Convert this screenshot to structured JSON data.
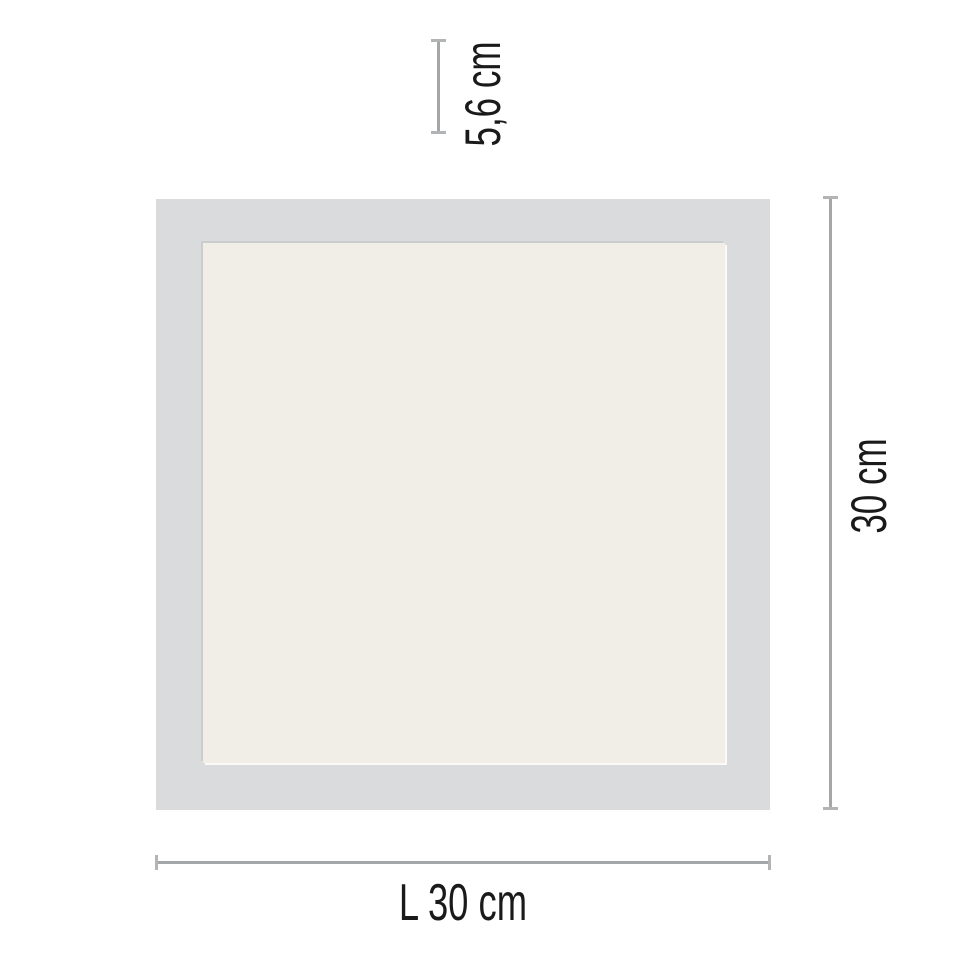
{
  "diagram": {
    "colors": {
      "background": "#ffffff",
      "frame": "#dadbdd",
      "face": "#f1ede7",
      "dim_line": "#a5a6a8",
      "dim_tick": "#b3b4b6",
      "text": "#1a1a1a"
    },
    "dimensions": {
      "depth": {
        "label": "5,6 cm"
      },
      "height": {
        "label": "30 cm"
      },
      "length": {
        "label": "L 30 cm"
      }
    }
  }
}
